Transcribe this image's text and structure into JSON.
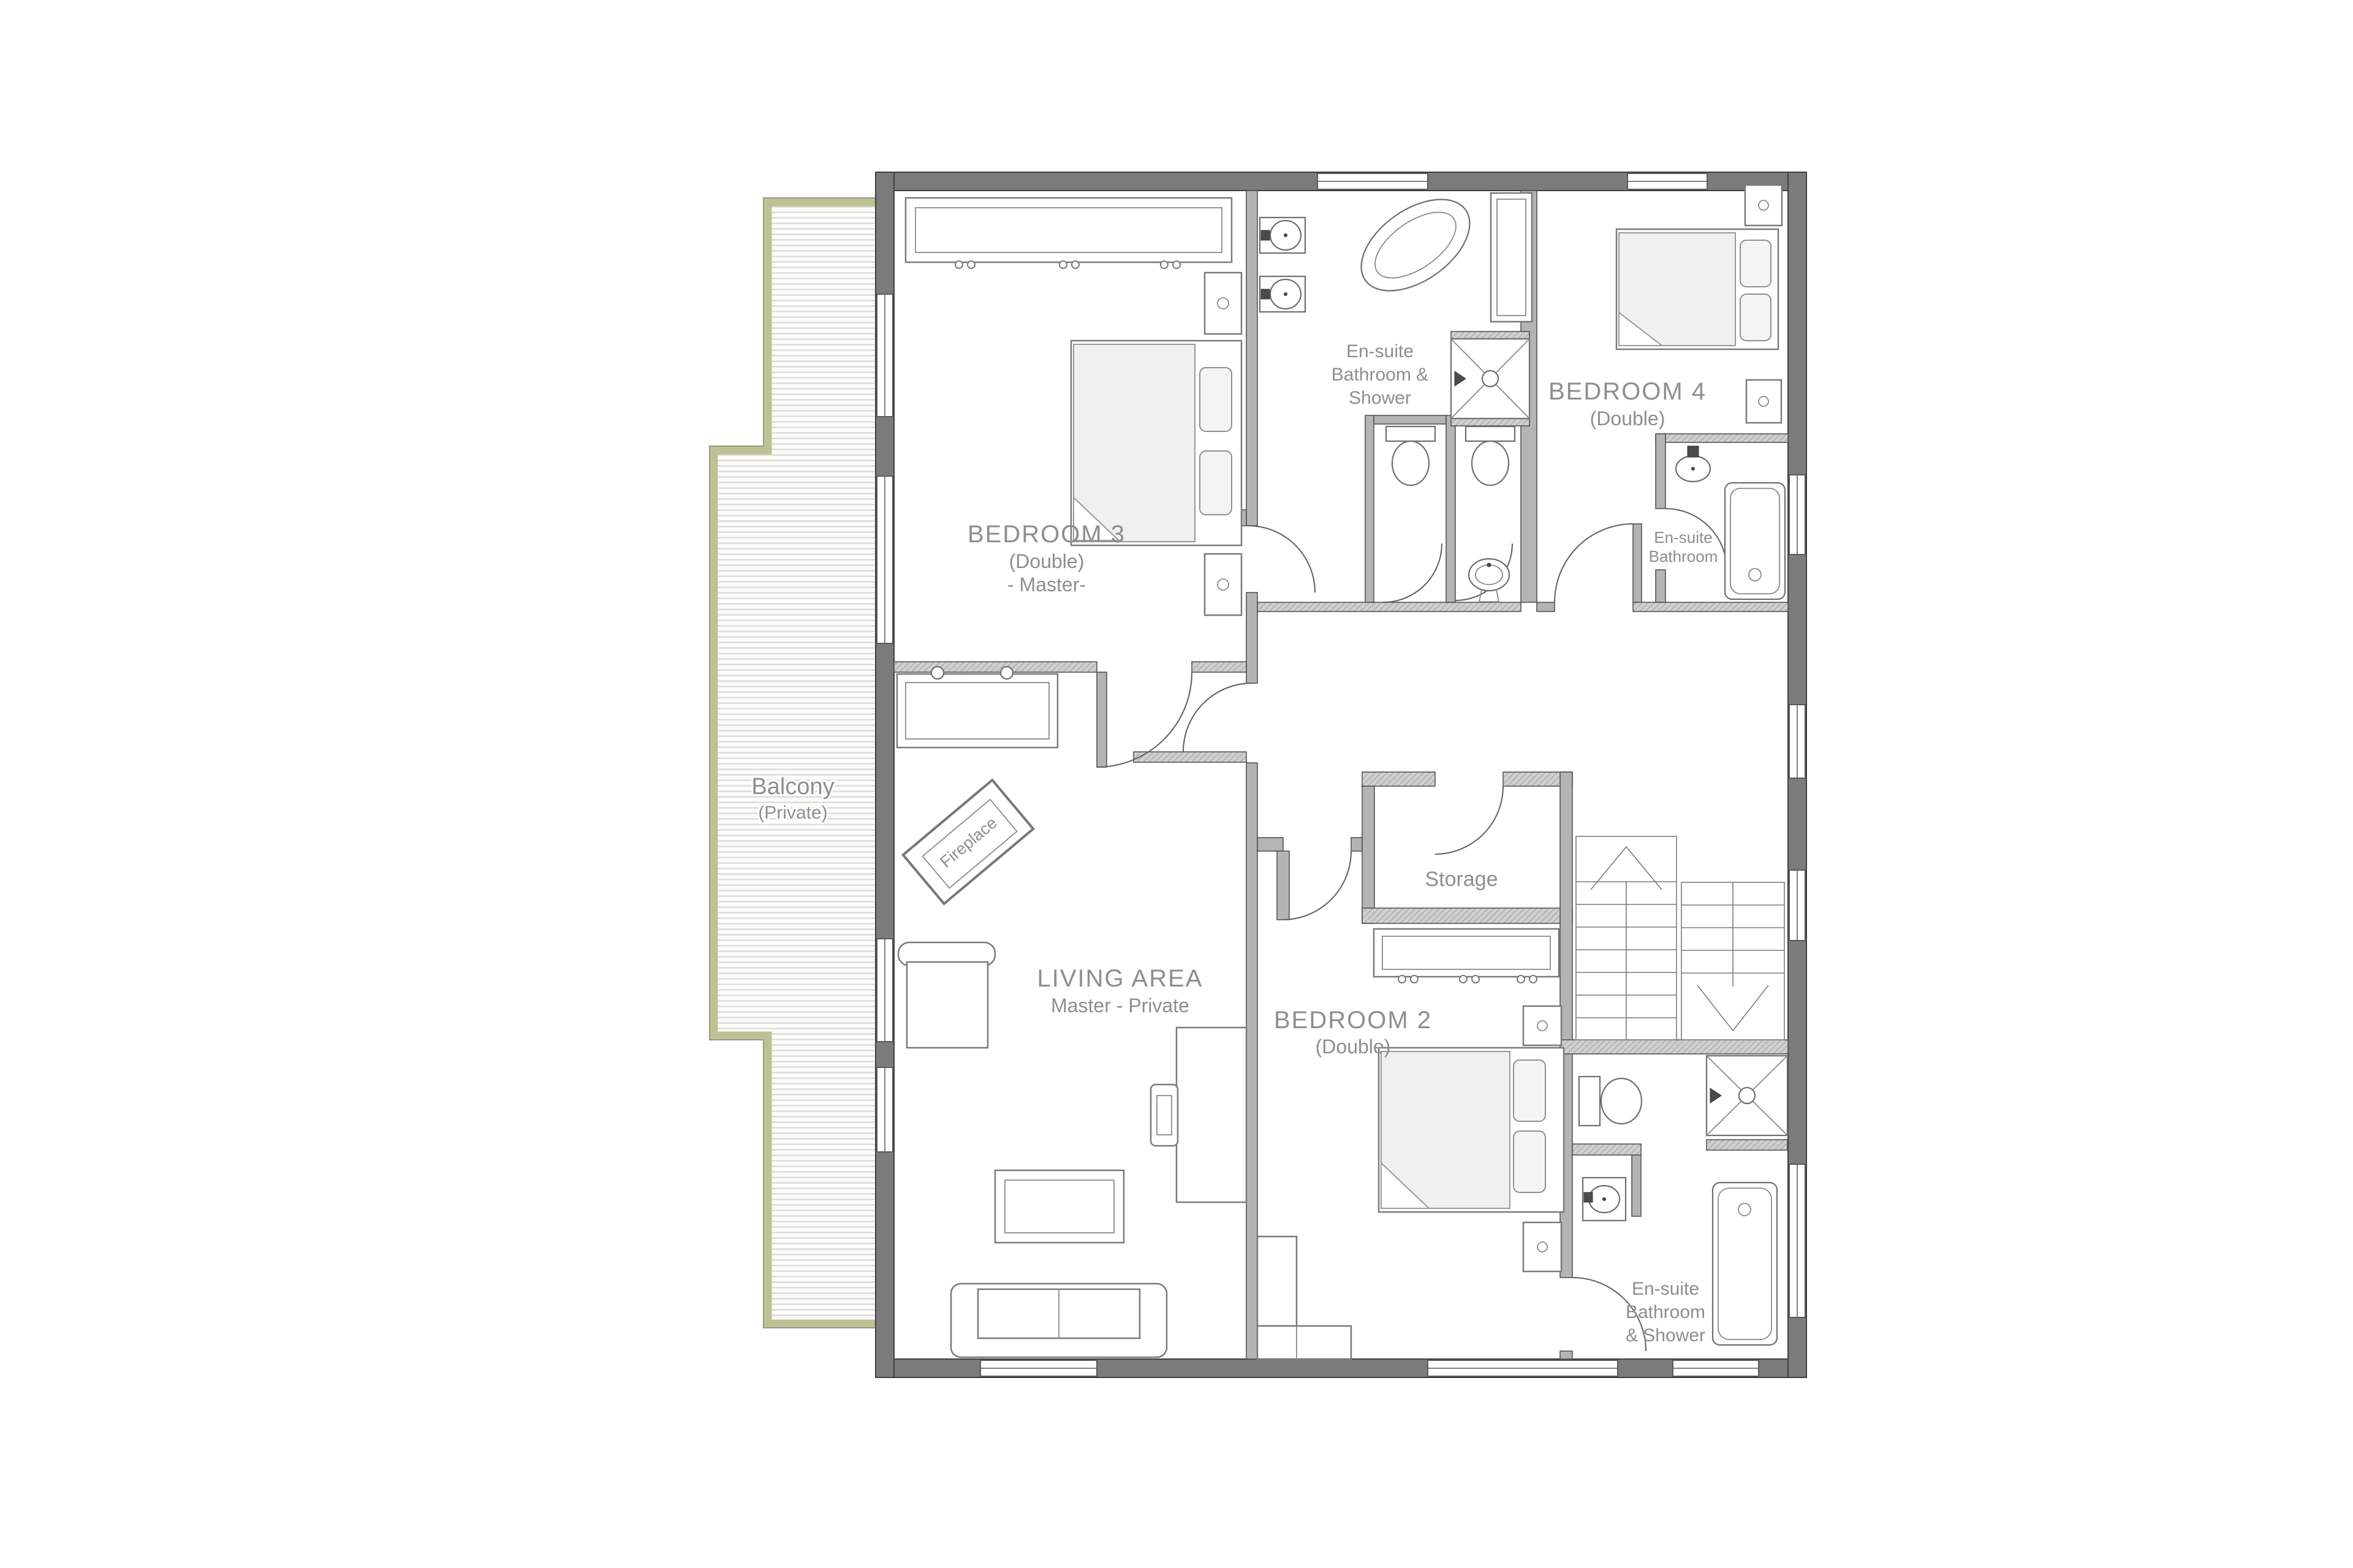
{
  "page": {
    "background": "#ffffff"
  },
  "floor_plan": {
    "rooms": {
      "bedroom3": {
        "title": "BEDROOM 3",
        "subtitle": "(Double)",
        "note": "- Master-"
      },
      "living_area": {
        "title": "LIVING AREA",
        "subtitle": "Master - Private"
      },
      "balcony": {
        "title": "Balcony",
        "subtitle": "(Private)"
      },
      "master_ensuite": {
        "line1": "En-suite",
        "line2": "Bathroom &",
        "line3": "Shower"
      },
      "bedroom4": {
        "title": "BEDROOM 4",
        "subtitle": "(Double)"
      },
      "bedroom4_ensuite": {
        "line1": "En-suite",
        "line2": "Bathroom"
      },
      "storage": {
        "title": "Storage"
      },
      "bedroom2": {
        "title": "BEDROOM 2",
        "subtitle": "(Double)"
      },
      "bedroom2_ensuite": {
        "line1": "En-suite",
        "line2": "Bathroom",
        "line3": "& Shower"
      },
      "fireplace": {
        "label": "Fireplace"
      }
    },
    "colors": {
      "outer_wall": "#7b7b7b",
      "interior_wall": "#b4b4b4",
      "label_text": "#8e8e8e",
      "balcony_edge": "#bdc194",
      "fixture_line": "#6f6f6f"
    }
  }
}
